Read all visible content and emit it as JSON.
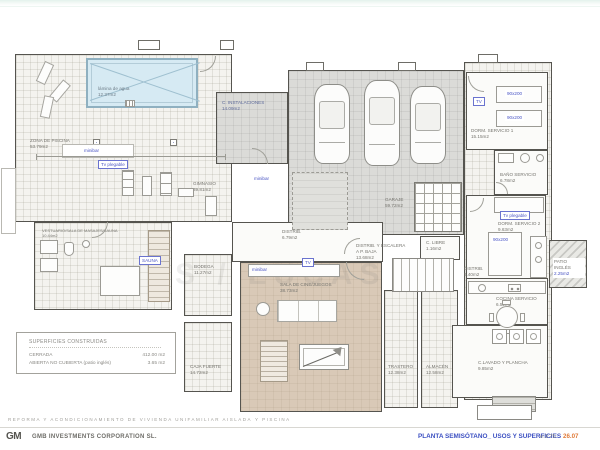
{
  "plan": {
    "watermark": "S / LUCAS",
    "rooms": {
      "piscina": {
        "name": "ZONA DE PISCINA",
        "area": "53.79m2"
      },
      "lamina": {
        "name": "lámina de agua",
        "area": "12.37m2"
      },
      "gimnasio": {
        "name": "GIMNASIO",
        "area": "39.81m2"
      },
      "vestuario": {
        "name": "VESTUARIO/SALA DE MASAJES/SAUNA",
        "area": "10.44m2"
      },
      "instalaciones": {
        "name": "C. INSTALACIONES",
        "area": "14.09m2"
      },
      "garaje": {
        "name": "GARAJE",
        "area": "59.72m2"
      },
      "dorm1": {
        "name": "DORM. SERVICIO 1",
        "area": "15.15m2"
      },
      "bano": {
        "name": "BAÑO SERVICIO",
        "area": "6.78m2"
      },
      "dorm2": {
        "name": "DORM. SERVICIO 2",
        "area": "9.63m2"
      },
      "patio": {
        "name": "PATIO INGLÉS",
        "area": "2.25m2"
      },
      "distrib_servicio": {
        "name": "DISTRIB.",
        "area": "5.40m2"
      },
      "cocina": {
        "name": "COCINA SERVICIO",
        "area": "6.52m2"
      },
      "lavado": {
        "name": "C.LAVADO Y PLANCHA",
        "area": "9.85m2"
      },
      "distrib_centro": {
        "name": "DISTRIB.",
        "area": "6.79m2"
      },
      "escalera": {
        "name": "DISTRIB. Y ESCALERA",
        "sub": "A P. BAJA",
        "area": "13.68m2"
      },
      "libre": {
        "name": "C. LIBRE",
        "area": "1.16m2"
      },
      "sala": {
        "name": "SALA DE CINE/JUEGOS",
        "area": "38.73m2"
      },
      "trastero": {
        "name": "TRASTERO",
        "area": "12.38m2"
      },
      "almacen": {
        "name": "ALMACÉN",
        "area": "12.58m2"
      },
      "bodega": {
        "name": "BODEGA",
        "area": "11.27m2"
      },
      "caja": {
        "name": "CAJA FUERTE",
        "area": "14.72m2"
      }
    },
    "labels": {
      "minibar": "minibar",
      "tv_plegable": "Tv plegable",
      "tv": "TV",
      "bed_size": "90x200",
      "sauna": "SAUNA"
    }
  },
  "legend": {
    "title": "SUPERFICIES CONSTRUIDAS",
    "rows": [
      {
        "label": "CERRADA",
        "value": "412.00 m2"
      },
      {
        "label": "ABIERTA NO CUBIERTA (patio inglés)",
        "value": "3.65 m2"
      }
    ]
  },
  "footer": {
    "project": "REFORMA Y ACONDICIONAMIENTO DE VIVIENDA UNIFAMILIAR AISLADA CON CHILL OUT",
    "project_tail": "Y PISCINA",
    "logo": "GM",
    "company": "GMB INVESTMENTS CORPORATION SL.",
    "sheet_title": "PLANTA SEMISÓTANO_ USOS Y SUPERFICIES",
    "scale": "e:1:75",
    "date": "26.07"
  },
  "colors": {
    "accent_blue": "#4a55c4",
    "date_orange": "#e07b39",
    "garage_gray": "#dbdbd8",
    "cinema_tan": "#d9c9b7",
    "pool_blue": "#d6eaf3"
  }
}
